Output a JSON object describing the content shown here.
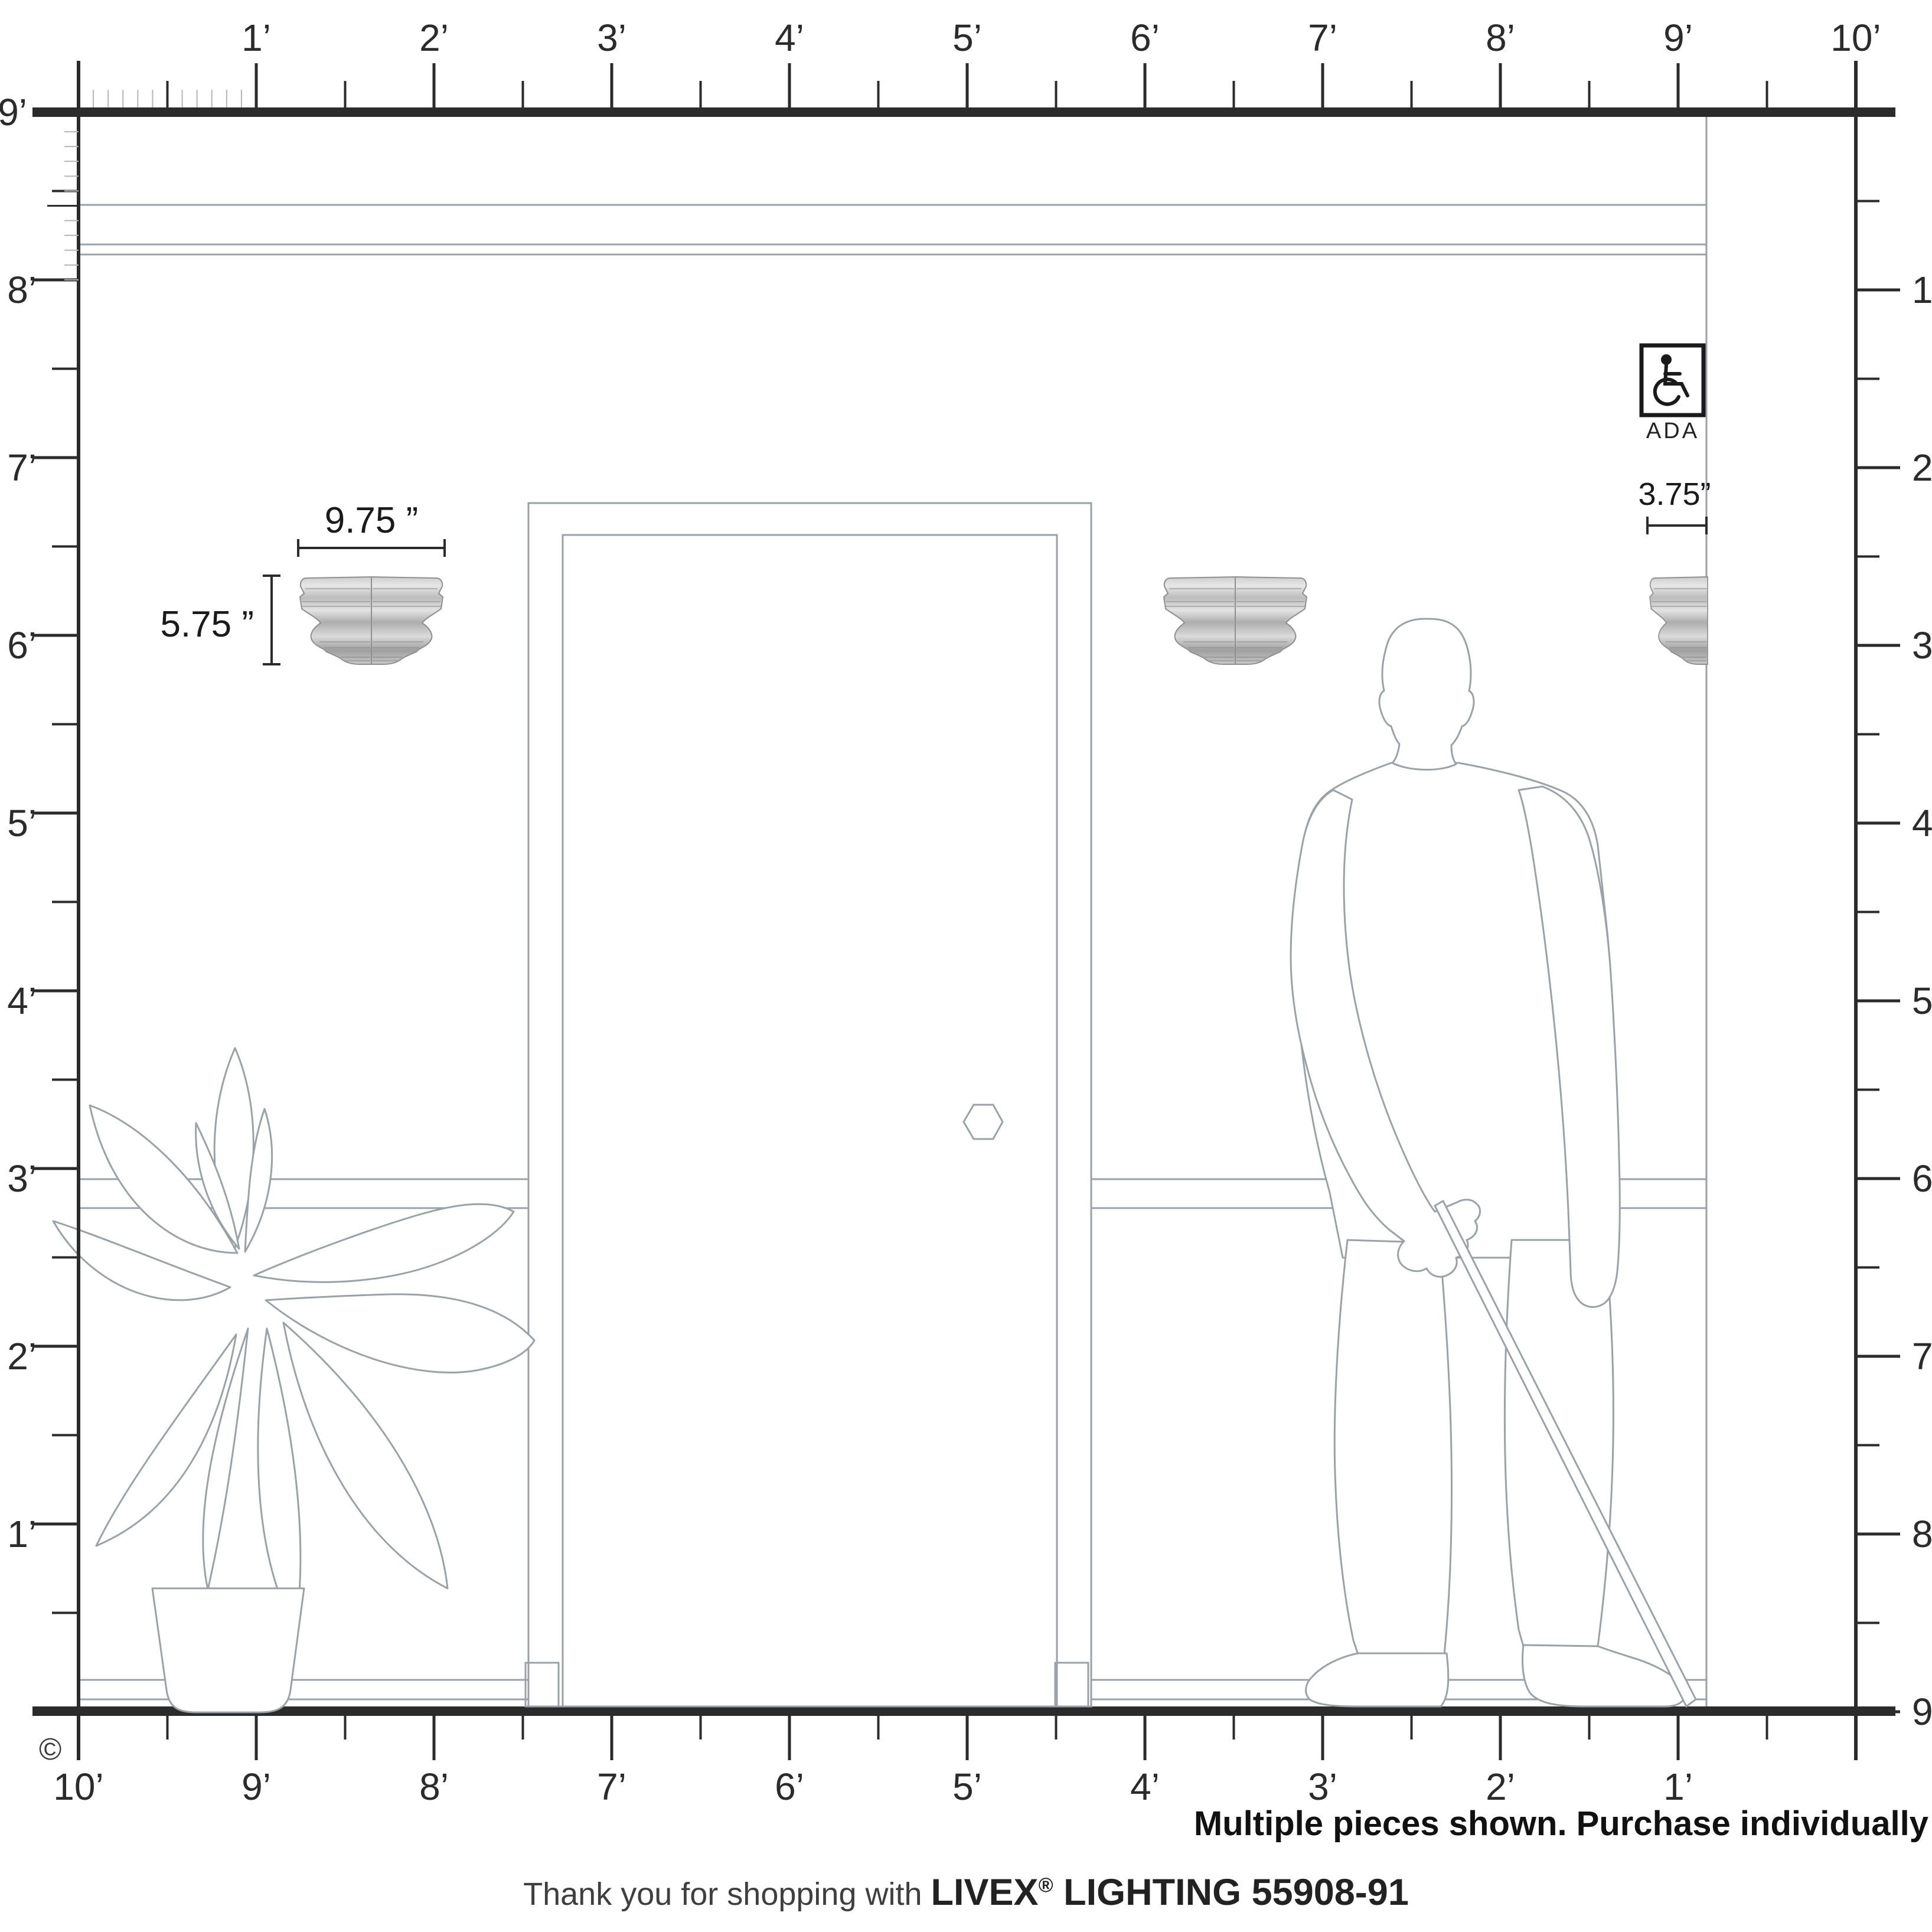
{
  "rulers": {
    "top": {
      "labels": [
        "1’",
        "2’",
        "3’",
        "4’",
        "5’",
        "6’",
        "7’",
        "8’",
        "9’",
        "10’"
      ]
    },
    "left": {
      "labels": [
        "9’",
        "8’",
        "7’",
        "6’",
        "5’",
        "4’",
        "3’",
        "2’",
        "1’"
      ]
    },
    "right": {
      "labels": [
        "1’",
        "2’",
        "3’",
        "4’",
        "5’",
        "6’",
        "7’",
        "8’",
        "9’"
      ]
    },
    "bottom": {
      "labels": [
        "10’",
        "9’",
        "8’",
        "7’",
        "6’",
        "5’",
        "4’",
        "3’",
        "2’",
        "1’"
      ]
    }
  },
  "dimensions": {
    "fixture_width": "9.75 ”",
    "fixture_height": "5.75 ”",
    "fixture_depth": "3.75”"
  },
  "ada": {
    "label": "ADA"
  },
  "copyright": "©",
  "footer": {
    "note": "Multiple pieces shown. Purchase individually",
    "thanks_prefix": "Thank you for shopping with ",
    "brand": "LIVEX",
    "registered": "®",
    "thanks_suffix": " LIGHTING 55908-91"
  },
  "colors": {
    "ruler": "#2b2b2b",
    "wall_lines": "#9aa2a8",
    "metal_light": "#e8e8e8",
    "metal_dark": "#9f9f9f"
  }
}
